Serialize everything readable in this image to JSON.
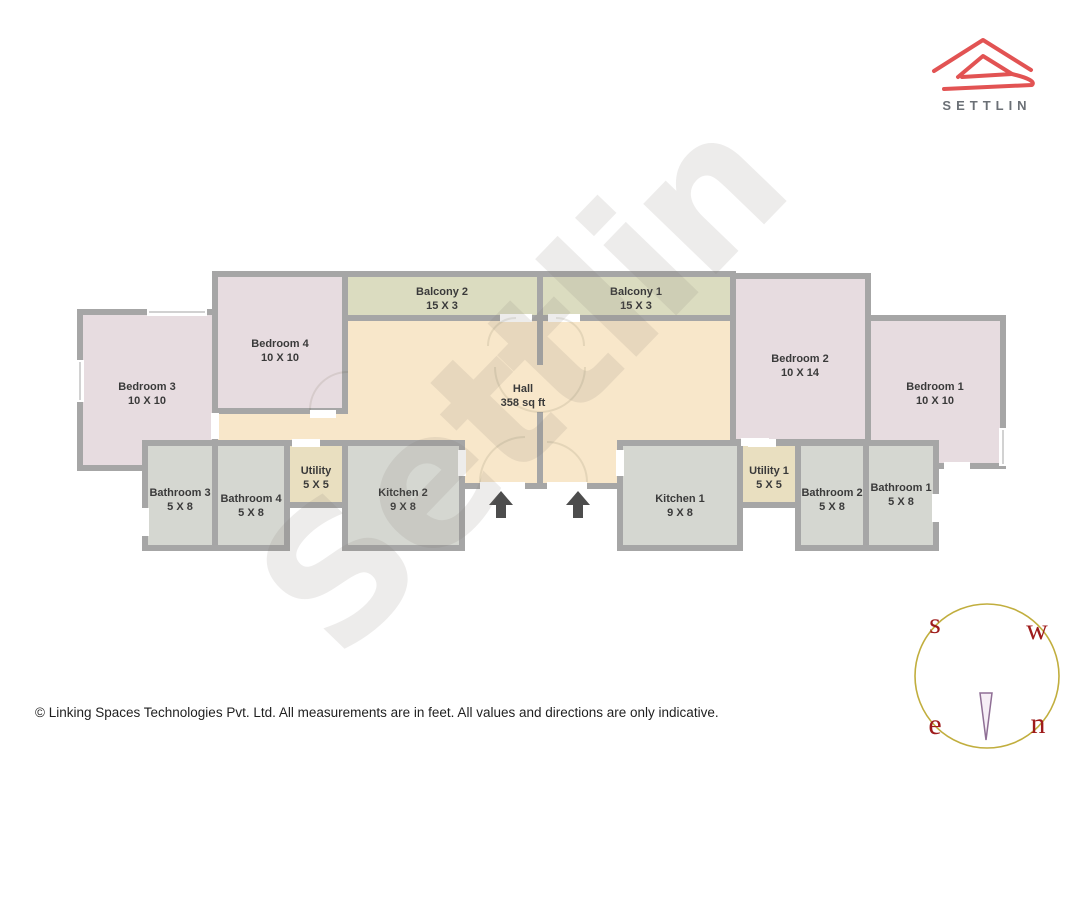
{
  "logo": {
    "brand": "SETTLIN"
  },
  "watermark": {
    "text": "Settlin"
  },
  "plan": {
    "rooms": [
      {
        "name": "Bedroom 3",
        "dims": "10 X 10"
      },
      {
        "name": "Bedroom 4",
        "dims": "10 X 10"
      },
      {
        "name": "Balcony 2",
        "dims": "15 X 3"
      },
      {
        "name": "Balcony 1",
        "dims": "15 X 3"
      },
      {
        "name": "Hall",
        "dims": "358 sq ft"
      },
      {
        "name": "Bedroom 2",
        "dims": "10 X 14"
      },
      {
        "name": "Bedroom 1",
        "dims": "10 X 10"
      },
      {
        "name": "Bathroom 3",
        "dims": "5 X 8"
      },
      {
        "name": "Bathroom 4",
        "dims": "5 X 8"
      },
      {
        "name": "Utility",
        "dims": "5 X 5"
      },
      {
        "name": "Kitchen 2",
        "dims": "9 X 8"
      },
      {
        "name": "Kitchen 1",
        "dims": "9 X 8"
      },
      {
        "name": "Utility 1",
        "dims": "5 X 5"
      },
      {
        "name": "Bathroom 2",
        "dims": "5 X 8"
      },
      {
        "name": "Bathroom 1",
        "dims": "5 X 8"
      }
    ],
    "colors": {
      "wall": "#a6a6a6",
      "bedroom": "#e7dce0",
      "balcony": "#dbdcc0",
      "hall": "#f8e7ca",
      "kitchen": "#d5d7d1",
      "bathroom": "#d5d7d1",
      "utility": "#e9dfc0",
      "arrow": "#4d4d4d",
      "logo_red": "#e25353",
      "brand_gray": "#6b7076",
      "compass_circle": "#c1ae3e",
      "compass_letters": "#9e1b1b",
      "needle": "#8f6f95"
    }
  },
  "compass": {
    "s": "s",
    "w": "w",
    "e": "e",
    "n": "n"
  },
  "footer": {
    "text": "© Linking Spaces Technologies Pvt. Ltd. All measurements are in feet. All values and directions are only indicative."
  }
}
